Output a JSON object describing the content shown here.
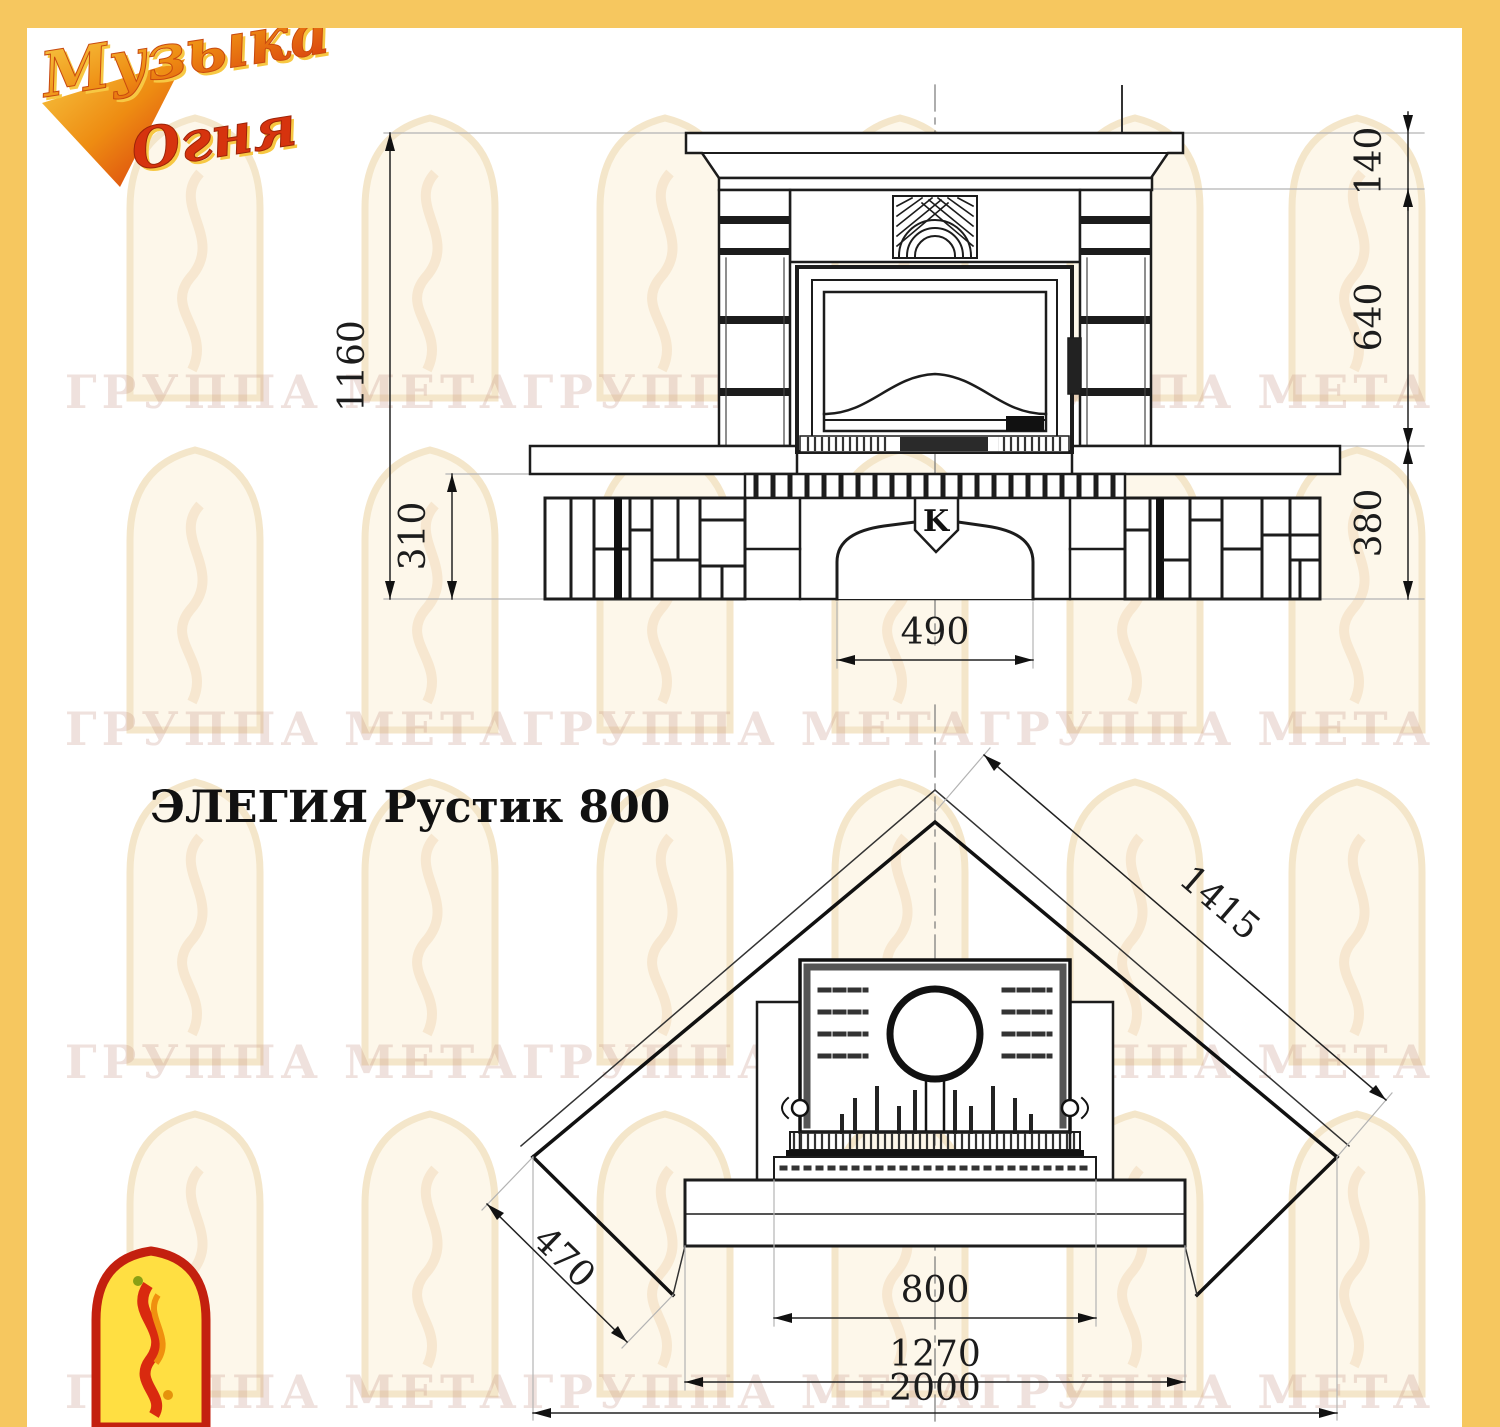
{
  "brand": {
    "logo_top": {
      "line1": "Музыка",
      "line2": "Огня"
    }
  },
  "title": {
    "text": "ЭЛЕГИЯ Рустик 800"
  },
  "watermark": {
    "text": "ГРУППА МЕТАГРУППА МЕТАГРУППА МЕТА"
  },
  "front_view": {
    "emblem": "K",
    "dims": {
      "total_height": "1160",
      "plinth_height": "310",
      "niche_width": "490",
      "cornice_height": "140",
      "middle_height": "640",
      "base_height": "380"
    }
  },
  "plan_view": {
    "dims": {
      "diagonal_width": "1415",
      "side_depth": "470",
      "firebox_width": "800",
      "bench_width": "1270",
      "overall_width": "2000"
    }
  },
  "colors": {
    "accent_yellow": "#f6c75f",
    "logo_orange": "#e87b12",
    "logo_red": "#d6330e",
    "line_dark": "#1c1c1c",
    "watermark_cream": "#fdf7e8"
  }
}
